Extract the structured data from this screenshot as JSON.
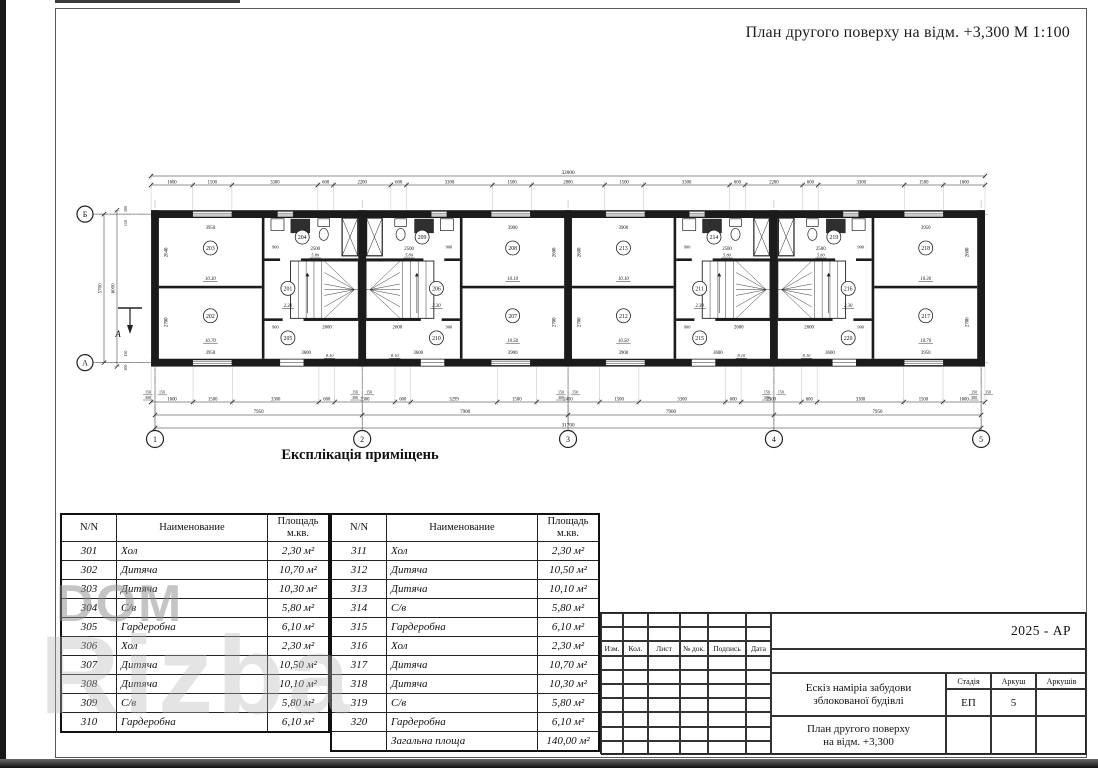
{
  "page": {
    "title": "План другого поверху на відм. +3,300  М 1:100"
  },
  "watermark": {
    "text_top": "DOM",
    "text_big": "Rizba"
  },
  "plan": {
    "axes_bottom": [
      "1",
      "2",
      "3",
      "4",
      "5"
    ],
    "axes_left": {
      "top": "Б",
      "bottom": "А"
    },
    "section_mark": "А",
    "dim_total_top": "32000",
    "dims_top": [
      "1600",
      "1500",
      "3300",
      "600",
      "2200",
      "600",
      "3300",
      "1500",
      "2800",
      "1500",
      "3300",
      "600",
      "2200",
      "600",
      "3300",
      "1500",
      "1600"
    ],
    "dims_bottom": [
      "1600",
      "1500",
      "3300",
      "600",
      "2300",
      "600",
      "3299",
      "1500",
      "2400",
      "1500",
      "3300",
      "600",
      "2300",
      "600",
      "3300",
      "1500",
      "1600"
    ],
    "dims_bottom_spans": [
      "7950",
      "7900",
      "7900",
      "7950"
    ],
    "dim_total_bottom": "31700",
    "dims_left": {
      "overall": "6000",
      "between_axes": "5700",
      "small": [
        "300",
        "150"
      ]
    },
    "axis_small_dims": [
      "150",
      "150",
      "300"
    ],
    "units": [
      {
        "mirrored": false,
        "rooms": {
          "hall": {
            "no": "201",
            "area": "2.30"
          },
          "room_top": {
            "no": "203",
            "area": "10.30",
            "w": "3950",
            "h": "2640"
          },
          "room_bottom": {
            "no": "202",
            "area": "10.70",
            "w": "3950",
            "h": "2700"
          },
          "bath": {
            "no": "204",
            "area": "5.80",
            "w": "2500",
            "entry_w": "900"
          },
          "wardrobe": {
            "no": "205",
            "w": "3600",
            "stair_w": "2600",
            "entry_w": "900"
          },
          "stair_area": "8.10"
        }
      },
      {
        "mirrored": true,
        "rooms": {
          "hall": {
            "no": "206",
            "area": "2.30"
          },
          "room_top": {
            "no": "208",
            "area": "10.10",
            "w": "3900",
            "h": "2600"
          },
          "room_bottom": {
            "no": "207",
            "area": "10.50",
            "w": "3900",
            "h": "2700"
          },
          "bath": {
            "no": "209",
            "area": "5.80",
            "w": "2500",
            "entry_w": "900"
          },
          "wardrobe": {
            "no": "210",
            "w": "3600",
            "stair_w": "2600",
            "entry_w": "900"
          },
          "stair_area": "8.10"
        }
      },
      {
        "mirrored": false,
        "rooms": {
          "hall": {
            "no": "211",
            "area": "2.30"
          },
          "room_top": {
            "no": "213",
            "area": "10.10",
            "w": "3900",
            "h": "2600"
          },
          "room_bottom": {
            "no": "212",
            "area": "10.50",
            "w": "3900",
            "h": "2700"
          },
          "bath": {
            "no": "214",
            "area": "5.80",
            "w": "2500",
            "entry_w": "900"
          },
          "wardrobe": {
            "no": "215",
            "w": "3600",
            "stair_w": "2600",
            "entry_w": "900"
          },
          "stair_area": "8.10"
        }
      },
      {
        "mirrored": true,
        "rooms": {
          "hall": {
            "no": "216",
            "area": "2.30"
          },
          "room_top": {
            "no": "218",
            "area": "10.30",
            "w": "3950",
            "h": "2600"
          },
          "room_bottom": {
            "no": "217",
            "area": "10.70",
            "w": "3950",
            "h": "2700"
          },
          "bath": {
            "no": "219",
            "area": "5.80",
            "w": "2500",
            "entry_w": "900"
          },
          "wardrobe": {
            "no": "220",
            "w": "3600",
            "stair_w": "2600",
            "entry_w": "900"
          },
          "stair_area": "8.10"
        }
      }
    ]
  },
  "explication": {
    "heading": "Експлікація приміщень",
    "headers": {
      "num": "N/N",
      "name": "Наименование",
      "area_l1": "Площадь",
      "area_l2": "м.кв."
    },
    "left_rows": [
      [
        "301",
        "Хол",
        "2,30 м²"
      ],
      [
        "302",
        "Дитяча",
        "10,70 м²"
      ],
      [
        "303",
        "Дитяча",
        "10,30 м²"
      ],
      [
        "304",
        "С/в",
        "5,80 м²"
      ],
      [
        "305",
        "Гардеробна",
        "6,10 м²"
      ],
      [
        "306",
        "Хол",
        "2,30 м²"
      ],
      [
        "307",
        "Дитяча",
        "10,50 м²"
      ],
      [
        "308",
        "Дитяча",
        "10,10 м²"
      ],
      [
        "309",
        "С/в",
        "5,80 м²"
      ],
      [
        "310",
        "Гардеробна",
        "6,10 м²"
      ]
    ],
    "right_rows": [
      [
        "311",
        "Хол",
        "2,30 м²"
      ],
      [
        "312",
        "Дитяча",
        "10,50 м²"
      ],
      [
        "313",
        "Дитяча",
        "10,10 м²"
      ],
      [
        "314",
        "С/в",
        "5,80 м²"
      ],
      [
        "315",
        "Гардеробна",
        "6,10 м²"
      ],
      [
        "316",
        "Хол",
        "2,30 м²"
      ],
      [
        "317",
        "Дитяча",
        "10,70 м²"
      ],
      [
        "318",
        "Дитяча",
        "10,30 м²"
      ],
      [
        "319",
        "С/в",
        "5,80 м²"
      ],
      [
        "320",
        "Гардеробна",
        "6,10 м²"
      ]
    ],
    "total_label": "Загальна площа",
    "total_value": "140,00 м²"
  },
  "titleblock": {
    "doc_code": "2025 - АР",
    "revision_columns": [
      "Изм.",
      "Кол.",
      "Лист",
      "№ док.",
      "Подпись",
      "Дата"
    ],
    "project_title_l1": "Ескіз наміріа забудови",
    "project_title_l2": "зблокованої будівлі",
    "sheet_title_l1": "План другого поверху",
    "sheet_title_l2": "на відм. +3,300",
    "stage_label": "Стадія",
    "sheet_label": "Аркуш",
    "sheets_label": "Аркушів",
    "stage_value": "ЕП",
    "sheet_value": "5",
    "sheets_value": ""
  }
}
